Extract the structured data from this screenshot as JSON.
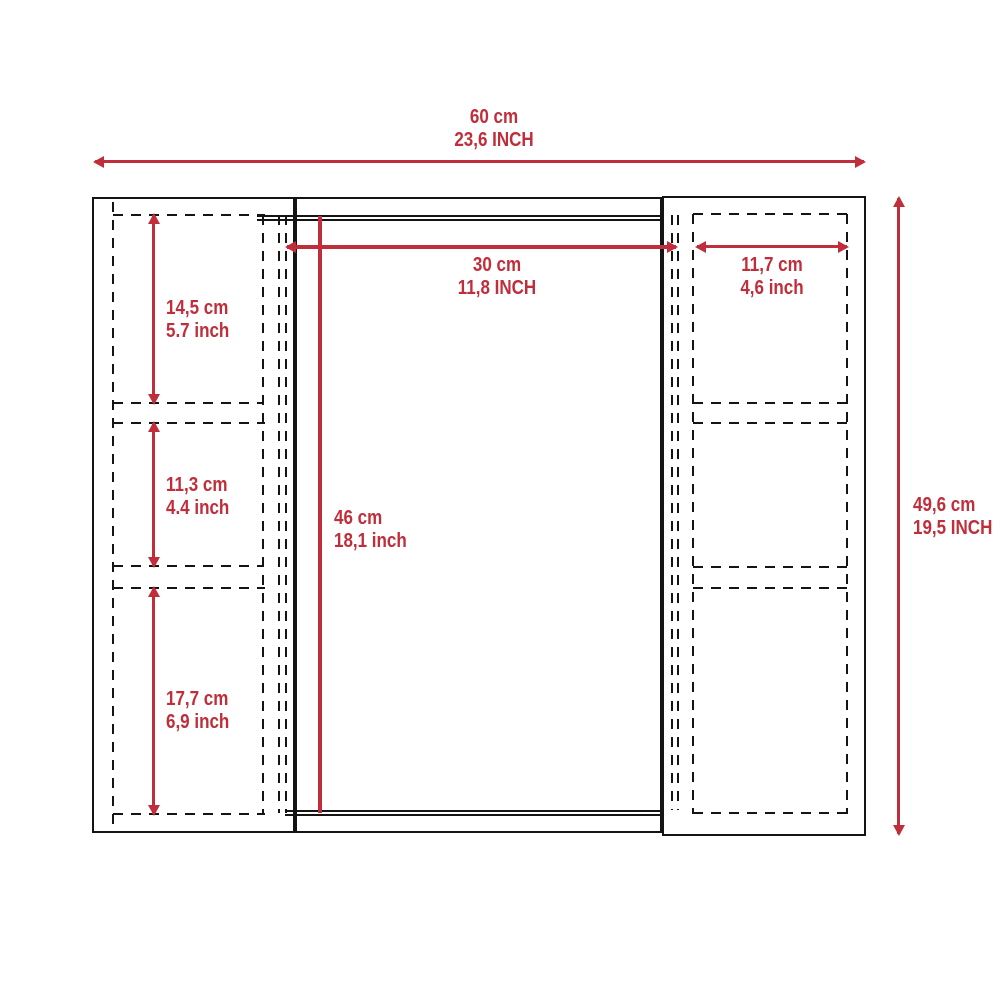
{
  "diagram": {
    "colors": {
      "dimension_red": "#bf2e3a",
      "outline_black": "#141414"
    },
    "dimensions": {
      "overall_width": {
        "metric": "60 cm",
        "imperial": "23,6 INCH"
      },
      "overall_height": {
        "metric": "49,6 cm",
        "imperial": "19,5 INCH"
      },
      "left_shelf_1_height": {
        "metric": "14,5 cm",
        "imperial": "5.7 inch"
      },
      "left_shelf_2_height": {
        "metric": "11,3 cm",
        "imperial": "4.4 inch"
      },
      "left_shelf_3_height": {
        "metric": "17,7 cm",
        "imperial": "6,9 inch"
      },
      "door_width": {
        "metric": "30 cm",
        "imperial": "11,8 INCH"
      },
      "door_height": {
        "metric": "46 cm",
        "imperial": "18,1 inch"
      },
      "right_shelf_width": {
        "metric": "11,7 cm",
        "imperial": "4,6 inch"
      }
    }
  }
}
